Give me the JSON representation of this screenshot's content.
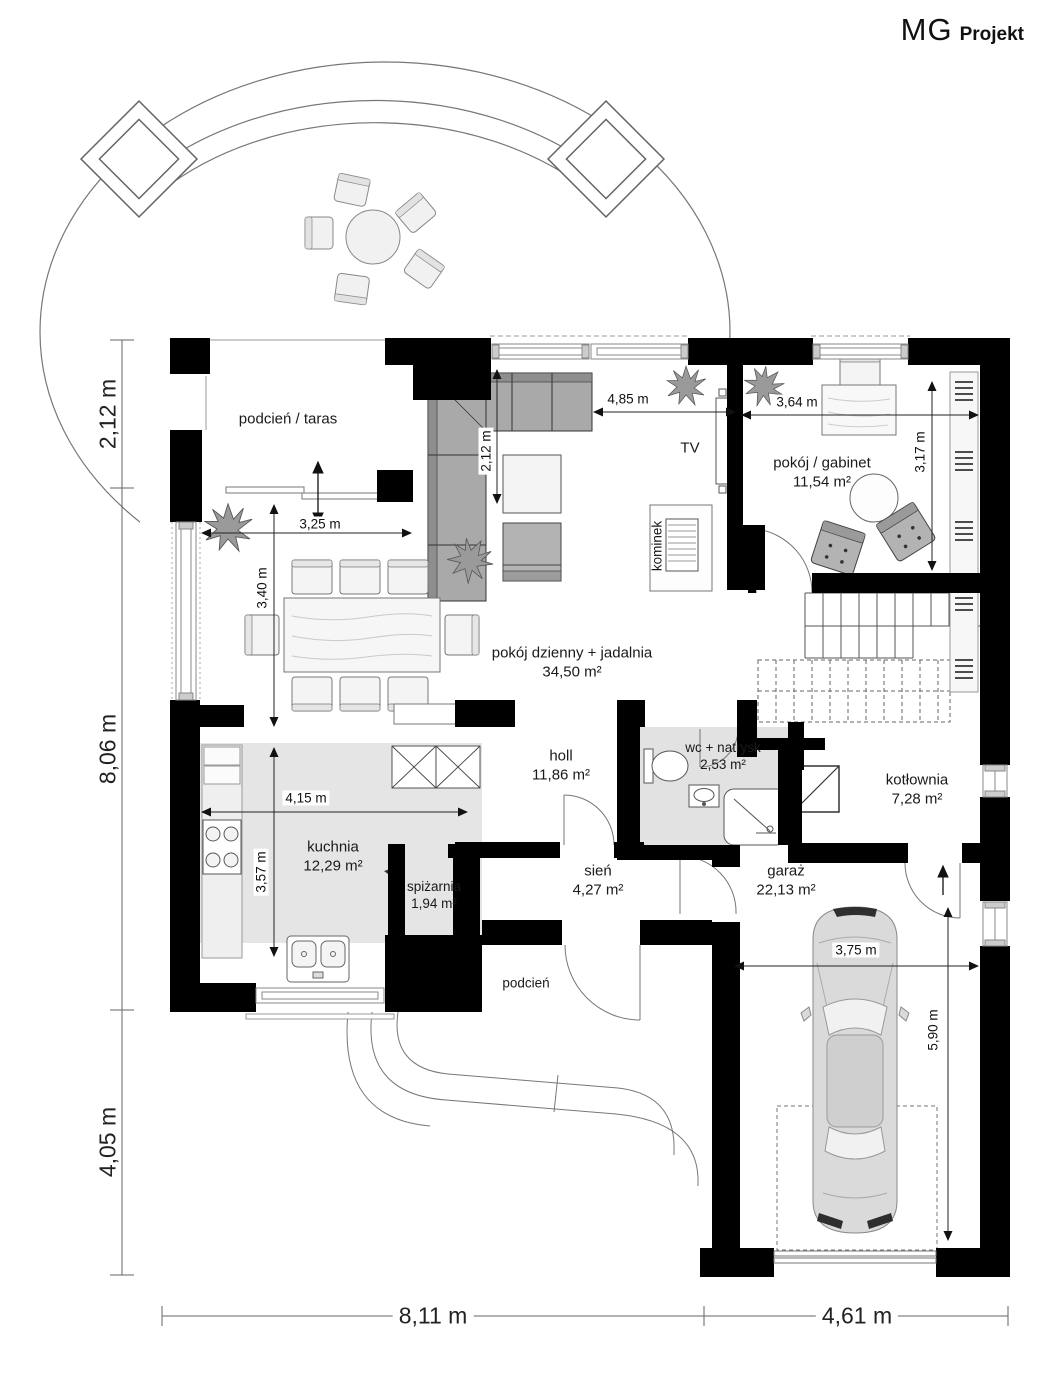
{
  "brand": {
    "bold": "MG",
    "light": "Projekt"
  },
  "rooms": {
    "taras": {
      "name": "podcień / taras"
    },
    "living": {
      "name": "pokój dzienny + jadalnia",
      "area": "34,50 m²"
    },
    "gabinet": {
      "name": "pokój / gabinet",
      "area": "11,54 m²"
    },
    "kuchnia": {
      "name": "kuchnia",
      "area": "12,29 m²"
    },
    "spizarnia": {
      "name": "spiżarnia",
      "area": "1,94 m²"
    },
    "holl": {
      "name": "holl",
      "area": "11,86 m²"
    },
    "wc": {
      "name": "wc + natrysk",
      "area": "2,53 m²"
    },
    "sien": {
      "name": "sień",
      "area": "4,27 m²"
    },
    "garaz": {
      "name": "garaż",
      "area": "22,13 m²"
    },
    "kotlownia": {
      "name": "kotłownia",
      "area": "7,28 m²"
    },
    "podcien": {
      "name": "podcień"
    },
    "kominek": {
      "name": "kominek"
    },
    "tv": {
      "name": "TV"
    }
  },
  "dims": {
    "outer_left_top": "2,12 m",
    "outer_left_mid": "8,06 m",
    "outer_left_bottom": "4,05 m",
    "outer_bottom_left": "8,11 m",
    "outer_bottom_right": "4,61 m",
    "taras_w": "3,25 m",
    "dining_h": "3,40 m",
    "living_w": "4,85 m",
    "sofa_d": "2,12 m",
    "gabinet_w": "3,64 m",
    "gabinet_h": "3,17 m",
    "kuchnia_w": "4,15 m",
    "kuchnia_h": "3,57 m",
    "garaz_w": "3,75 m",
    "garaz_h": "5,90 m"
  },
  "colors": {
    "wall": "#000000",
    "room_tint": "#e5e5e5",
    "furniture_gray": "#a9a9a9",
    "line": "#555555"
  }
}
